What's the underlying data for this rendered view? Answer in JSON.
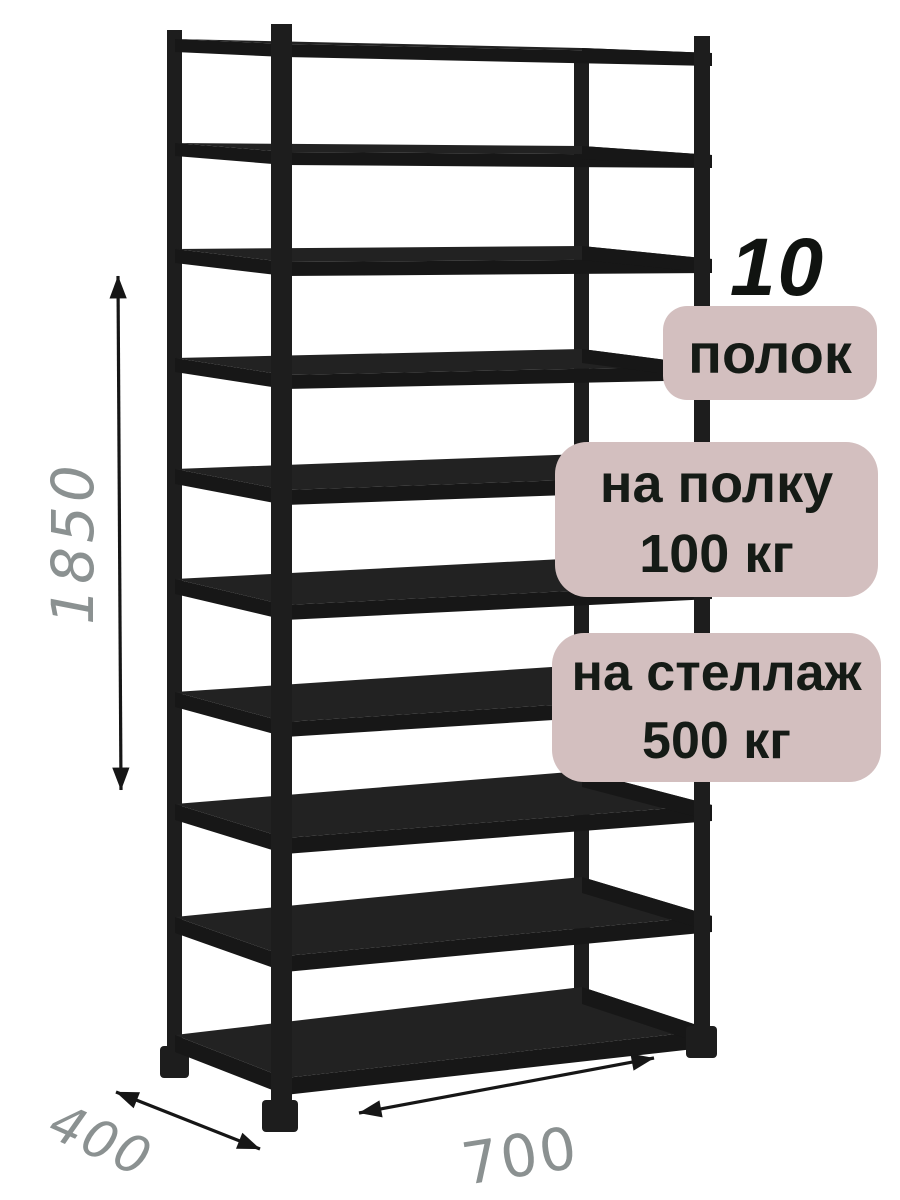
{
  "annotations": {
    "shelf_count": "10",
    "shelf_count_unit": "полок",
    "shelf_load_line1": "на полку",
    "shelf_load_line2": "100 кг",
    "rack_load_line1": "на стеллаж",
    "rack_load_line2": "500 кг"
  },
  "dimensions": {
    "height": "1850",
    "depth": "400",
    "width": "700"
  },
  "colors": {
    "background": "#ffffff",
    "rack": "#1d1d1d",
    "badge_bg": "#d3bfbf",
    "badge_text": "#151b16",
    "dimension_text": "#8b9191",
    "arrow": "#161616"
  }
}
